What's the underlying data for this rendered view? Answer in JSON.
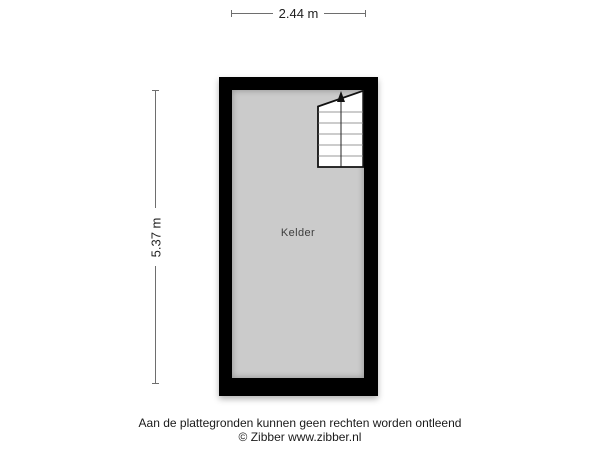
{
  "plan": {
    "room_label": "Kelder",
    "colors": {
      "wall": "#000000",
      "floor": "#cbcbcb",
      "stair_fill": "#ffffff",
      "dimension_line": "#6e6e6e",
      "text": "#1f1f1f"
    }
  },
  "dimensions": {
    "width_label": "2.44 m",
    "height_label": "5.37 m"
  },
  "footer": {
    "disclaimer": "Aan de plattegronden kunnen geen rechten worden ontleend",
    "copyright": "© Zibber www.zibber.nl"
  }
}
